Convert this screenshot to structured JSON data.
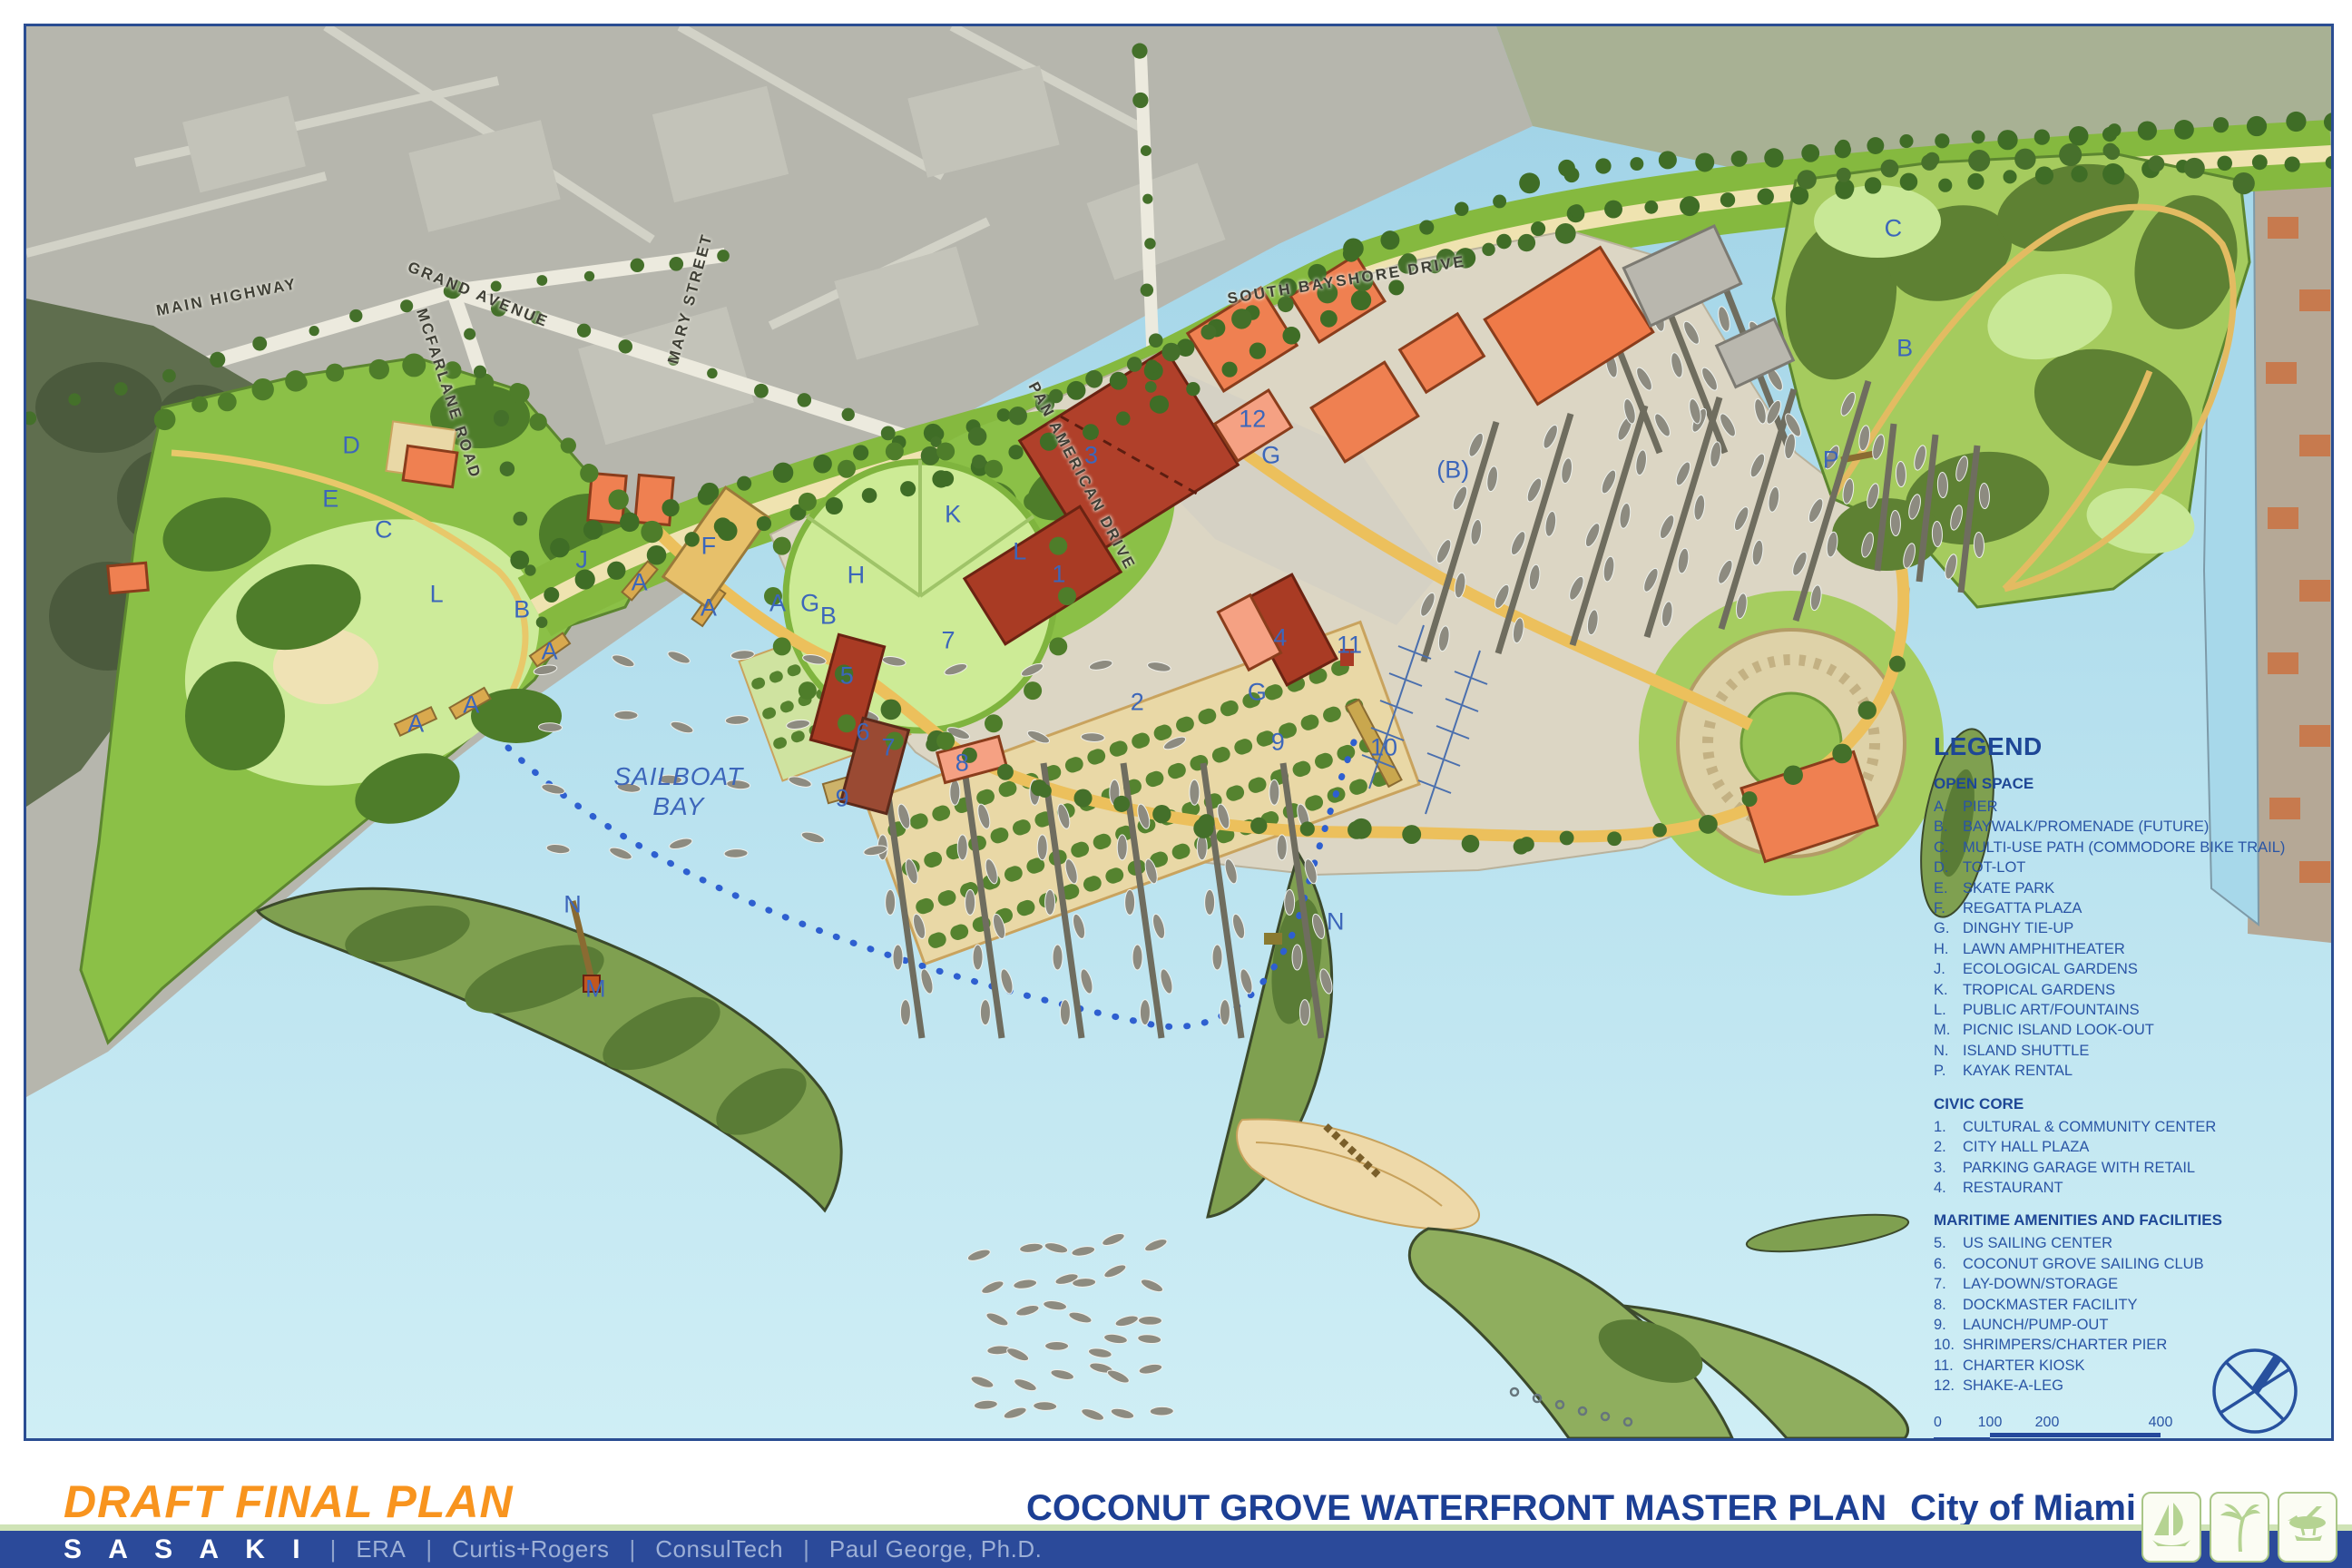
{
  "document": {
    "status_title": "DRAFT FINAL PLAN",
    "plan_title": "COCONUT GROVE WATERFRONT MASTER PLAN",
    "client": "City of Miami",
    "date": "JULY 2008"
  },
  "firms": {
    "primary": "S A S A K I",
    "separator": "|",
    "others": [
      {
        "label": "ERA"
      },
      {
        "label": "Curtis+Rogers"
      },
      {
        "label": "ConsulTech"
      },
      {
        "label": "Paul George, Ph.D."
      }
    ]
  },
  "legend": {
    "title": "LEGEND",
    "sections": [
      {
        "heading": "OPEN SPACE",
        "items": [
          {
            "key": "A.",
            "label": "PIER"
          },
          {
            "key": "B.",
            "label": "BAYWALK/PROMENADE (FUTURE)"
          },
          {
            "key": "C.",
            "label": "MULTI-USE PATH (COMMODORE BIKE TRAIL)"
          },
          {
            "key": "D.",
            "label": "TOT-LOT"
          },
          {
            "key": "E.",
            "label": "SKATE PARK"
          },
          {
            "key": "F.",
            "label": "REGATTA PLAZA"
          },
          {
            "key": "G.",
            "label": "DINGHY TIE-UP"
          },
          {
            "key": "H.",
            "label": "LAWN AMPHITHEATER"
          },
          {
            "key": "J.",
            "label": "ECOLOGICAL GARDENS"
          },
          {
            "key": "K.",
            "label": "TROPICAL GARDENS"
          },
          {
            "key": "L.",
            "label": "PUBLIC ART/FOUNTAINS"
          },
          {
            "key": "M.",
            "label": "PICNIC ISLAND LOOK-OUT"
          },
          {
            "key": "N.",
            "label": "ISLAND SHUTTLE"
          },
          {
            "key": "P.",
            "label": "KAYAK RENTAL"
          }
        ]
      },
      {
        "heading": "CIVIC CORE",
        "items": [
          {
            "key": "1.",
            "label": "CULTURAL & COMMUNITY CENTER"
          },
          {
            "key": "2.",
            "label": "CITY HALL PLAZA"
          },
          {
            "key": "3.",
            "label": "PARKING GARAGE WITH RETAIL"
          },
          {
            "key": "4.",
            "label": "RESTAURANT"
          }
        ]
      },
      {
        "heading": "MARITIME AMENITIES AND FACILITIES",
        "items": [
          {
            "key": "5.",
            "label": "US SAILING CENTER"
          },
          {
            "key": "6.",
            "label": "COCONUT GROVE SAILING CLUB"
          },
          {
            "key": "7.",
            "label": "LAY-DOWN/STORAGE"
          },
          {
            "key": "8.",
            "label": "DOCKMASTER FACILITY"
          },
          {
            "key": "9.",
            "label": "LAUNCH/PUMP-OUT"
          },
          {
            "key": "10.",
            "label": "SHRIMPERS/CHARTER PIER"
          },
          {
            "key": "11.",
            "label": "CHARTER KIOSK"
          },
          {
            "key": "12.",
            "label": "SHAKE-A-LEG"
          }
        ]
      }
    ],
    "scale": {
      "ticks": [
        "0",
        "100",
        "200",
        "400"
      ]
    },
    "date": "JULY 2008"
  },
  "map": {
    "bay_label_line1": "SAILBOAT",
    "bay_label_line2": "BAY",
    "street_labels": [
      {
        "t": "MAIN HIGHWAY",
        "x": 8.7,
        "y": 19.2,
        "r": -11
      },
      {
        "t": "GRAND AVENUE",
        "x": 19.6,
        "y": 19.0,
        "r": 22
      },
      {
        "t": "MCFARLANE ROAD",
        "x": 18.3,
        "y": 26.0,
        "r": 72
      },
      {
        "t": "MARY STREET",
        "x": 28.8,
        "y": 19.3,
        "r": -75
      },
      {
        "t": "SOUTH BAYSHORE DRIVE",
        "x": 57.3,
        "y": 18.0,
        "r": -9
      },
      {
        "t": "PAN AMERICAN DRIVE",
        "x": 45.8,
        "y": 31.9,
        "r": 62
      }
    ],
    "markers": [
      {
        "t": "D",
        "x": 14.1,
        "y": 29.7
      },
      {
        "t": "E",
        "x": 13.2,
        "y": 33.5
      },
      {
        "t": "C",
        "x": 15.5,
        "y": 35.7
      },
      {
        "t": "L",
        "x": 17.8,
        "y": 40.2
      },
      {
        "t": "J",
        "x": 24.1,
        "y": 37.8
      },
      {
        "t": "B",
        "x": 21.5,
        "y": 41.3
      },
      {
        "t": "A",
        "x": 16.9,
        "y": 49.4
      },
      {
        "t": "A",
        "x": 19.3,
        "y": 48.1
      },
      {
        "t": "A",
        "x": 22.7,
        "y": 44.3
      },
      {
        "t": "A",
        "x": 26.6,
        "y": 39.4
      },
      {
        "t": "A",
        "x": 29.6,
        "y": 41.2
      },
      {
        "t": "F",
        "x": 29.6,
        "y": 36.8
      },
      {
        "t": "H",
        "x": 36.0,
        "y": 38.9
      },
      {
        "t": "K",
        "x": 40.2,
        "y": 34.6
      },
      {
        "t": "L",
        "x": 43.1,
        "y": 37.2
      },
      {
        "t": "A",
        "x": 32.6,
        "y": 40.9
      },
      {
        "t": "G",
        "x": 34.0,
        "y": 40.9
      },
      {
        "t": "B",
        "x": 34.8,
        "y": 41.8
      },
      {
        "t": "5",
        "x": 35.6,
        "y": 46.0
      },
      {
        "t": "6",
        "x": 36.3,
        "y": 50.0
      },
      {
        "t": "7",
        "x": 40.0,
        "y": 43.5
      },
      {
        "t": "7",
        "x": 37.4,
        "y": 51.1
      },
      {
        "t": "8",
        "x": 40.6,
        "y": 52.2
      },
      {
        "t": "9",
        "x": 35.4,
        "y": 54.7
      },
      {
        "t": "1",
        "x": 44.8,
        "y": 38.8
      },
      {
        "t": "2",
        "x": 48.2,
        "y": 47.9
      },
      {
        "t": "3",
        "x": 46.2,
        "y": 30.4
      },
      {
        "t": "12",
        "x": 53.2,
        "y": 27.8
      },
      {
        "t": "G",
        "x": 54.0,
        "y": 30.4
      },
      {
        "t": "(B)",
        "x": 61.9,
        "y": 31.4
      },
      {
        "t": "P",
        "x": 78.3,
        "y": 30.7
      },
      {
        "t": "B",
        "x": 81.5,
        "y": 22.8
      },
      {
        "t": "C",
        "x": 81.0,
        "y": 14.3
      },
      {
        "t": "4",
        "x": 54.4,
        "y": 43.3
      },
      {
        "t": "G",
        "x": 53.4,
        "y": 47.2
      },
      {
        "t": "11",
        "x": 57.4,
        "y": 43.8
      },
      {
        "t": "9",
        "x": 54.3,
        "y": 50.7
      },
      {
        "t": "10",
        "x": 58.9,
        "y": 51.1
      },
      {
        "t": "N",
        "x": 23.7,
        "y": 62.2
      },
      {
        "t": "M",
        "x": 24.7,
        "y": 68.2
      },
      {
        "t": "N",
        "x": 56.8,
        "y": 63.4
      }
    ]
  },
  "colors": {
    "accent_orange": "#f8941e",
    "title_blue": "#1c3f94",
    "bar_blue": "#2b4a9a",
    "rule_green": "#cfe3b6",
    "water": "#aadcec",
    "park_green": "#8bc047",
    "building_red": "#a93b24",
    "building_orange": "#ef8051",
    "path_yellow": "#ecc05c",
    "label_blue": "#3c66ba"
  }
}
